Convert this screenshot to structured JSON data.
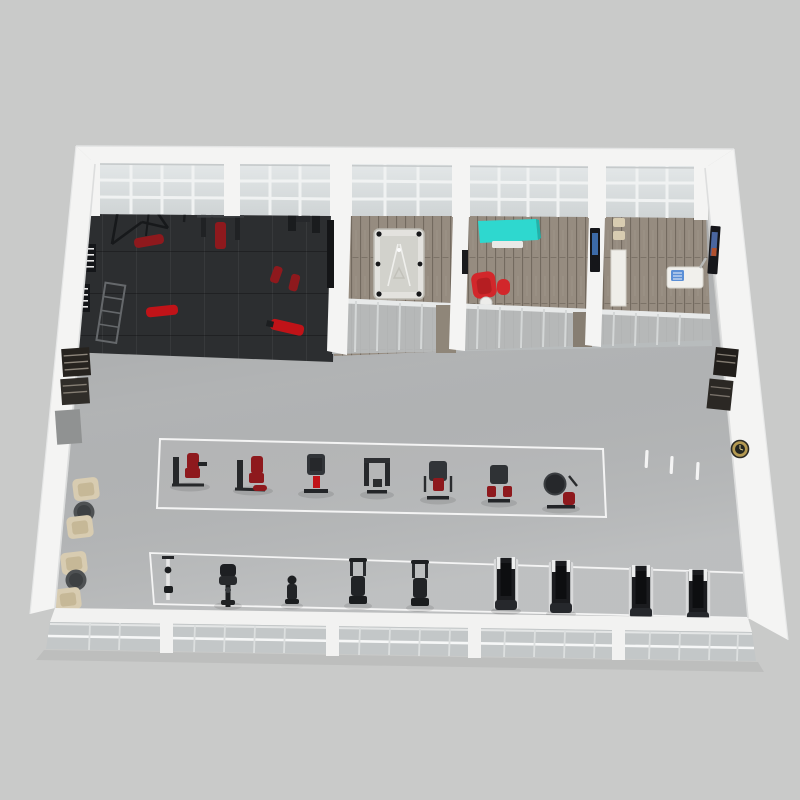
{
  "scene": {
    "type": "3d-floor-plan-render",
    "subject": "gym-fitness-center-floor-plan",
    "view": "high-angle-isometric",
    "visible_text": ""
  },
  "palette": {
    "background": "#c9cac9",
    "wall_white": "#f4f4f3",
    "wall_shadow": "#d7d9d9",
    "window_glass": "#d8dcdd",
    "window_glass_low": "#c3c7c8",
    "window_frame": "#f0f2f2",
    "main_floor": "#b5b7b8",
    "dark_floor": "#2c2e30",
    "wood_floor": "#968c80",
    "equipment_black": "#1b1d1f",
    "equipment_gray": "#595c5e",
    "equipment_red": "#8e191d",
    "bright_red": "#c01318",
    "chair_red": "#d2272b",
    "beige": "#d8ccb1",
    "cyan_desk": "#2ed8cf",
    "silver": "#d9dadb",
    "clock_gold": "#b49a52",
    "marking_white": "#f4f4f4"
  },
  "zones": {
    "free_weights_area": {
      "floor": "dark-rubber-tile",
      "equipment": [
        "power-rack",
        "half-rack",
        "bench-press-station",
        "dumbbell-rack",
        "dumbbell-rack",
        "storage-rack",
        "red-adjustable-bench",
        "red-flat-bench",
        "cable-crossover",
        "red-utility-bench",
        "red-utility-bench",
        "red-incline-bench"
      ]
    },
    "billiards_room": {
      "floor": "wood-plank",
      "furniture": [
        "pool-table"
      ]
    },
    "lounge_room": {
      "floor": "wood-plank",
      "furniture": [
        "cyan-reception-desk",
        "red-armchair",
        "red-ottoman",
        "white-stool",
        "wall-tv"
      ]
    },
    "office_room": {
      "floor": "wood-plank",
      "furniture": [
        "storage-cabinet",
        "side-chair",
        "side-chair",
        "computer-desk",
        "blue-device",
        "wall-tv"
      ]
    },
    "strength_machine_row": {
      "machine_count": 7,
      "marking": "white-floor-outline"
    },
    "cardio_row": {
      "machine_count": 9,
      "machines": [
        "functional-trainer",
        "recumbent-bike",
        "stepper",
        "elliptical",
        "elliptical",
        "treadmill",
        "treadmill",
        "treadmill",
        "treadmill"
      ],
      "treadmill_count": 4,
      "marking": "white-floor-outline"
    },
    "waiting_area": {
      "armchair_count": 4,
      "side_table_count": 2
    },
    "floor_markings": {
      "white_dash_count": 3
    },
    "wall_fixtures": [
      "left-wall-rack",
      "left-wall-panel",
      "right-wall-rack",
      "right-wall-rack",
      "wall-clock"
    ]
  }
}
